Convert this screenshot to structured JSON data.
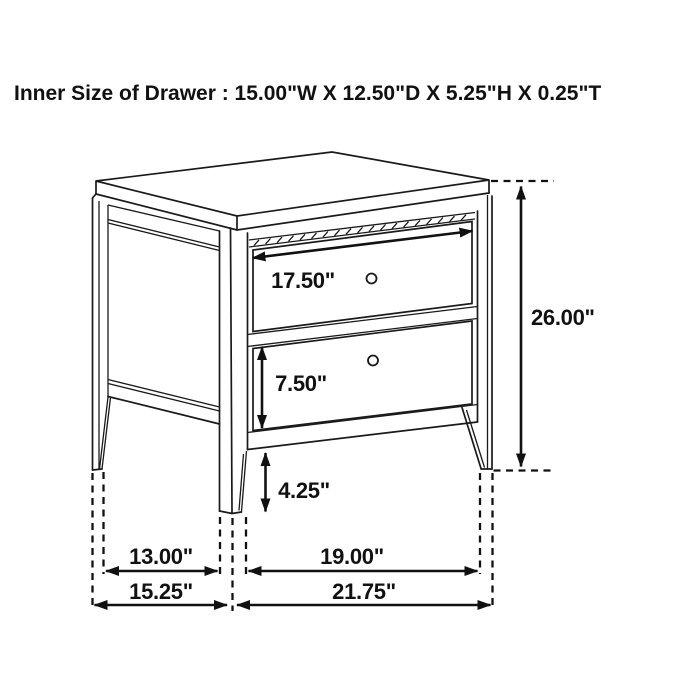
{
  "canvas": {
    "width": 700,
    "height": 700,
    "background": "#ffffff",
    "ink": "#1a1a1a"
  },
  "header": {
    "title": "Inner Size of Drawer : 15.00\"W X 12.50\"D X 5.25\"H X 0.25\"T"
  },
  "diagram": {
    "subject": "two-drawer nightstand dimension line drawing",
    "drawer_count": 2,
    "dimension_labels": {
      "top_drawer_width": "17.50\"",
      "bottom_drawer_height": "7.50\"",
      "floor_clearance": "4.25\"",
      "overall_height": "26.00\"",
      "side_leg_span": "13.00\"",
      "front_leg_span": "19.00\"",
      "overall_depth": "15.25\"",
      "overall_width": "21.75\""
    },
    "inner_drawer_size": {
      "width": "15.00\"",
      "depth": "12.50\"",
      "height": "5.25\"",
      "thickness": "0.25\""
    }
  }
}
